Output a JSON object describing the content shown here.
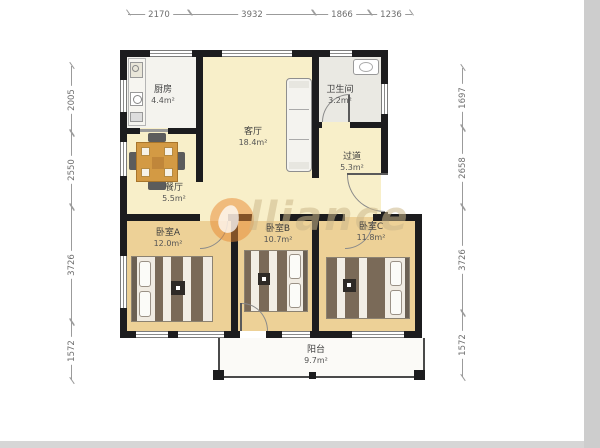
{
  "watermark": {
    "text": "lliance"
  },
  "rooms": {
    "kitchen": {
      "name": "厨房",
      "area": "4.4m²"
    },
    "living": {
      "name": "客厅",
      "area": "18.4m²"
    },
    "bath": {
      "name": "卫生间",
      "area": "3.2m²"
    },
    "hall": {
      "name": "过道",
      "area": "5.3m²"
    },
    "dining": {
      "name": "餐厅",
      "area": "5.5m²"
    },
    "bedroomA": {
      "name": "卧室A",
      "area": "12.0m²"
    },
    "bedroomB": {
      "name": "卧室B",
      "area": "10.7m²"
    },
    "bedroomC": {
      "name": "卧室C",
      "area": "11.8m²"
    },
    "balcony": {
      "name": "阳台",
      "area": "9.7m²"
    }
  },
  "dimensions": {
    "top": [
      "2170",
      "3932",
      "1866",
      "1236"
    ],
    "left": [
      "2005",
      "2550",
      "3726",
      "1572"
    ],
    "right": [
      "1697",
      "2658",
      "3726",
      "1572"
    ]
  },
  "colors": {
    "wall": "#1c1c1e",
    "floor_main": "#f8efc9",
    "floor_bedroom": "#edd197",
    "floor_kitchen": "#f4f3ee",
    "floor_bath": "#eae9e3",
    "watermark_orange": "#e88830"
  }
}
